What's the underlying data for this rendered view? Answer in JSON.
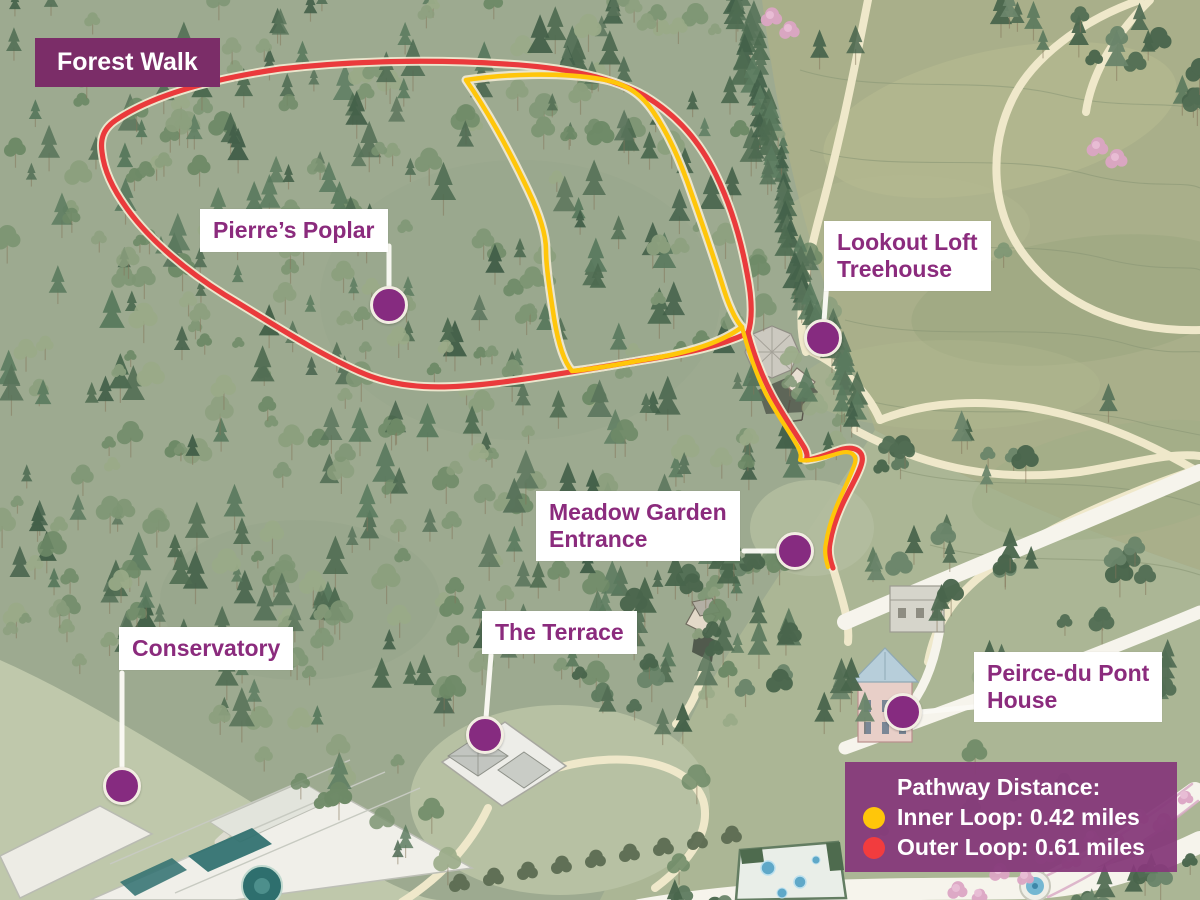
{
  "map": {
    "badge": "Forest Walk",
    "locations": [
      {
        "name": "Pierre’s Poplar",
        "lines": [
          "Pierre’s Poplar"
        ]
      },
      {
        "name": "Lookout Loft Treehouse",
        "lines": [
          "Lookout Loft",
          "Treehouse"
        ]
      },
      {
        "name": "Meadow Garden Entrance",
        "lines": [
          "Meadow Garden",
          "Entrance"
        ]
      },
      {
        "name": "The Terrace",
        "lines": [
          "The Terrace"
        ]
      },
      {
        "name": "Conservatory",
        "lines": [
          "Conservatory"
        ]
      },
      {
        "name": "Peirce-du Pont House",
        "lines": [
          "Peirce-du Pont",
          "House"
        ]
      }
    ],
    "legend": {
      "title": "Pathway Distance:",
      "items": [
        {
          "label": "Inner Loop: 0.42 miles",
          "color": "#FFC60A"
        },
        {
          "label": "Outer Loop: 0.61 miles",
          "color": "#F23C3E"
        }
      ]
    },
    "colors": {
      "badge_purple": "#7B2D68",
      "label_text_purple": "#8B2B7D",
      "marker_purple": "#862B80",
      "inner_loop": "#FFC60A",
      "outer_loop": "#F23C3E",
      "legend_background": "#863A7A"
    }
  }
}
